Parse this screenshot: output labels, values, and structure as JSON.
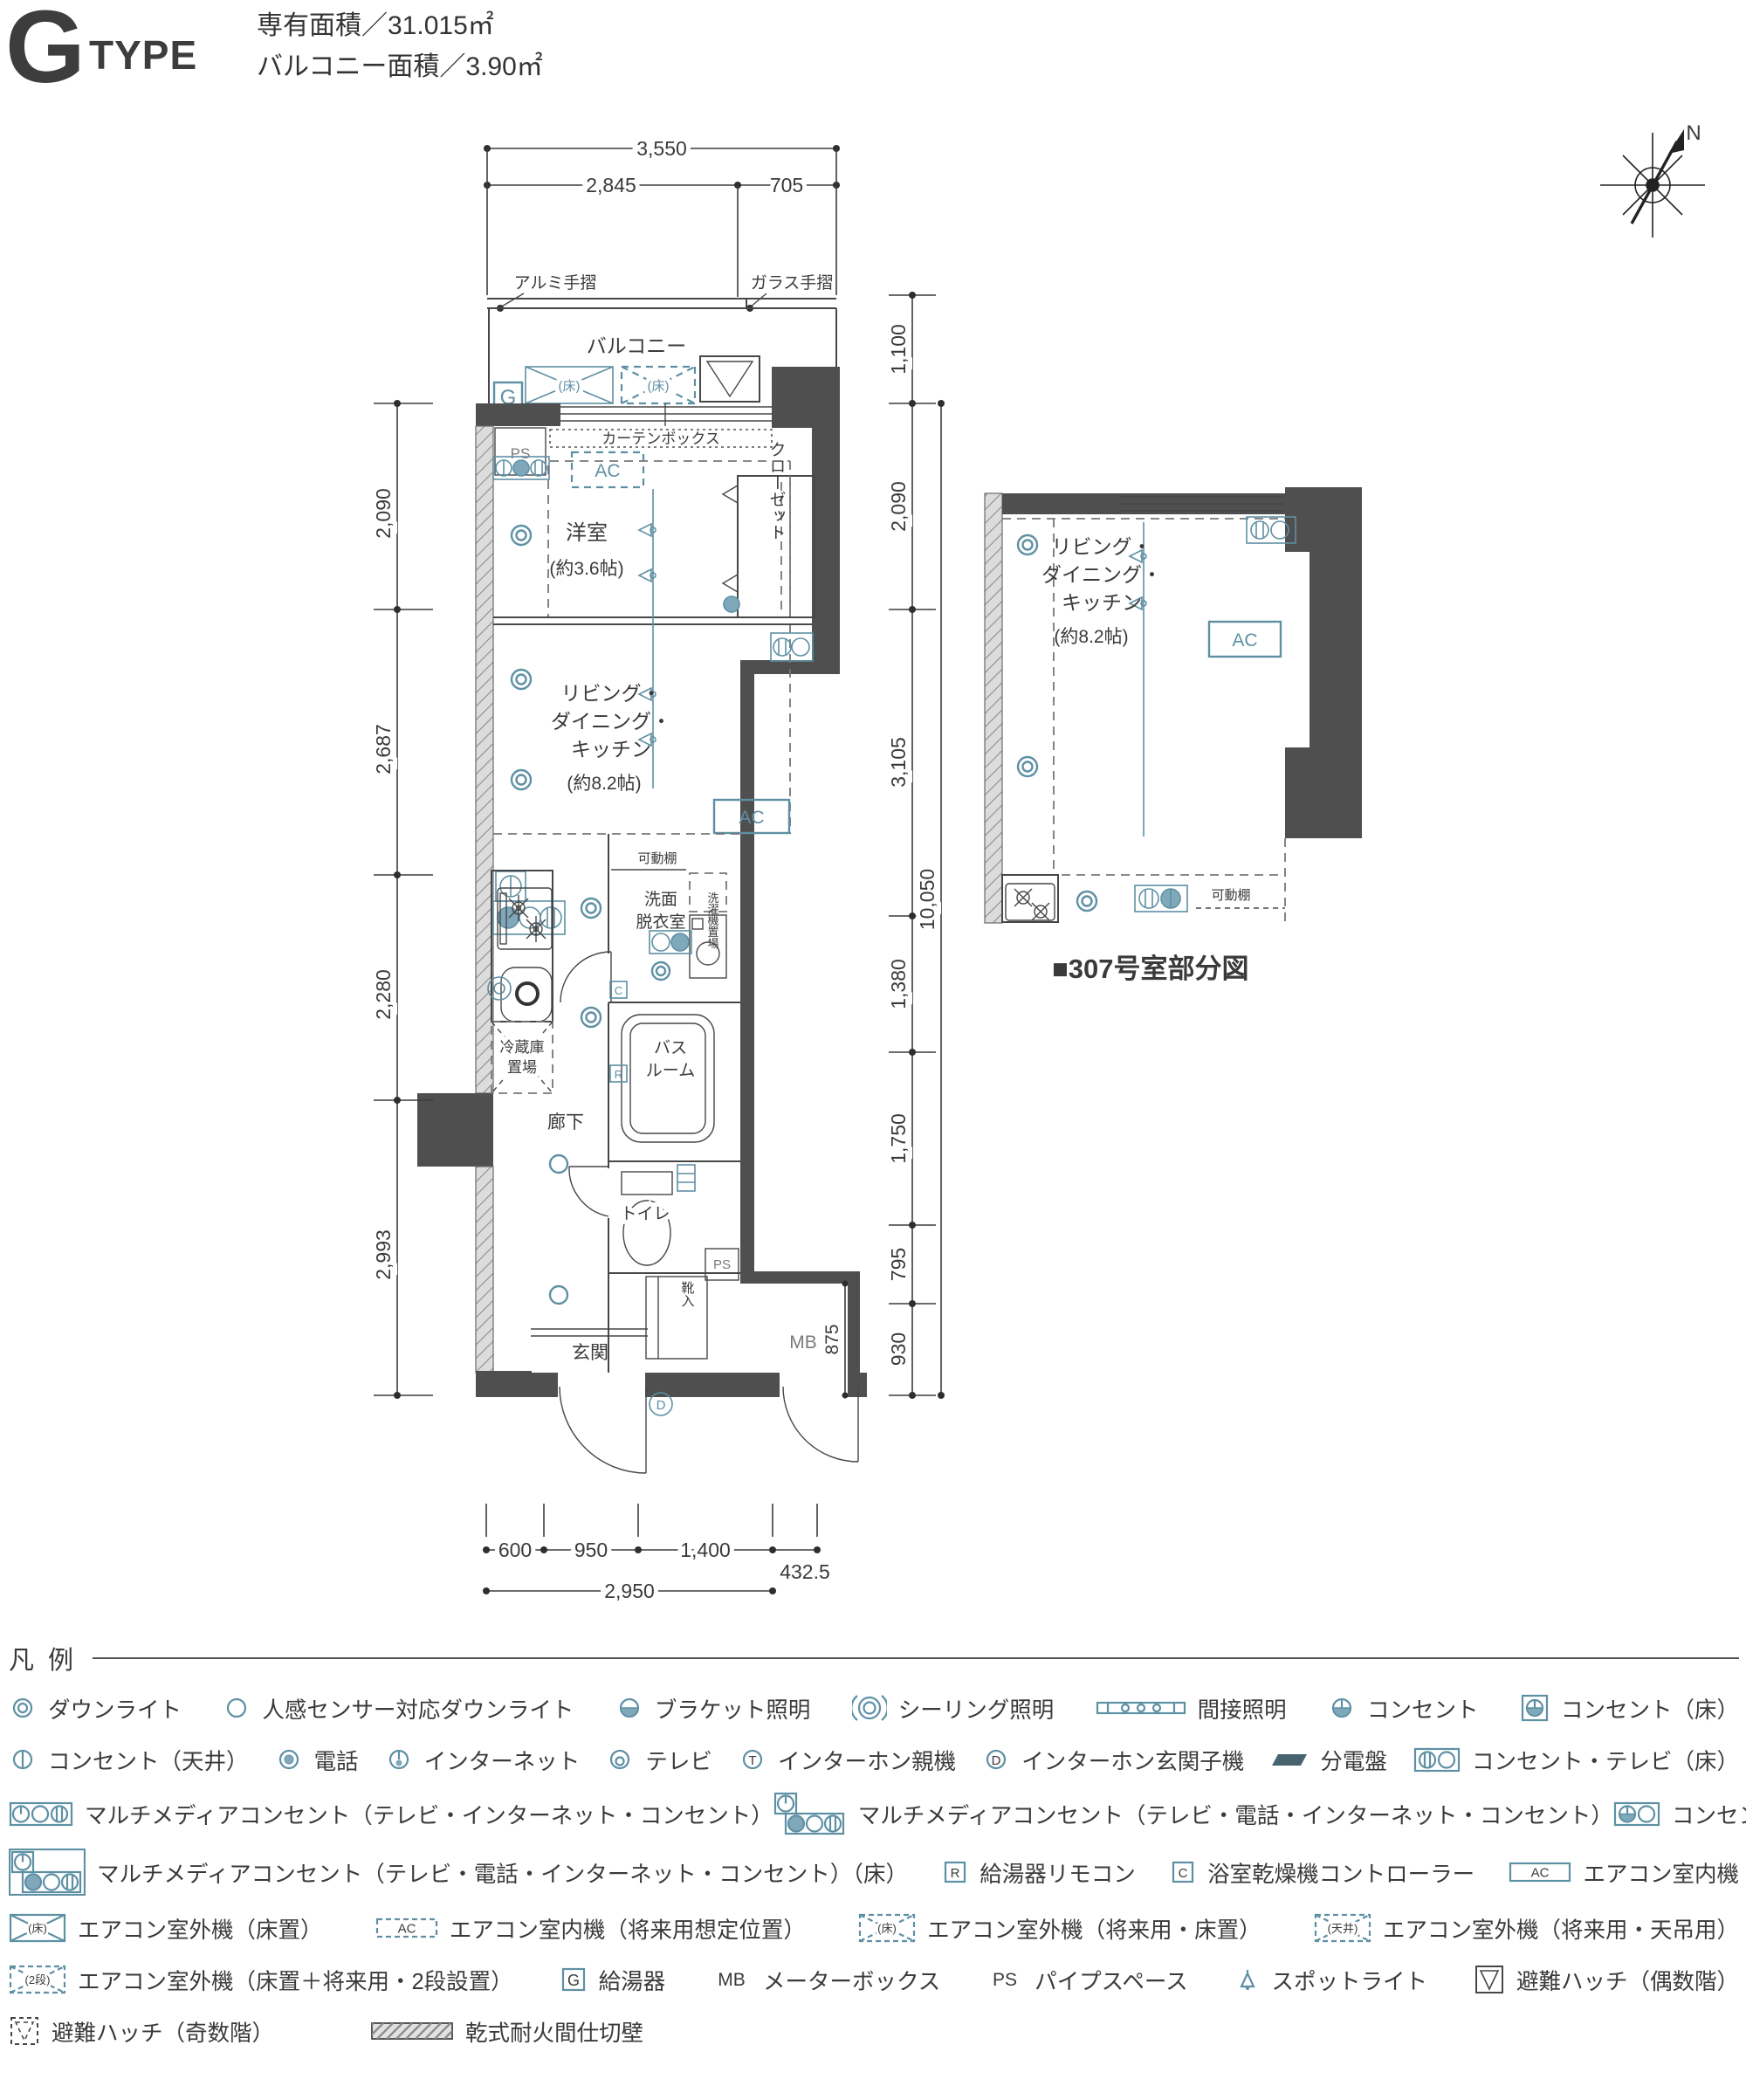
{
  "header": {
    "type_letter": "G",
    "type_word": "TYPE",
    "area_line1": "専有面積／31.015㎡",
    "area_line2": "バルコニー面積／3.90㎡"
  },
  "compass": {
    "n_label": "N"
  },
  "plan": {
    "labels": {
      "aluminum_rail": "アルミ手摺",
      "glass_rail": "ガラス手摺",
      "balcony": "バルコニー",
      "g": "G",
      "floor_mark": "(床)",
      "ps": "PS",
      "curtain_box": "カーテンボックス",
      "ac": "AC",
      "closet": "クローゼット",
      "yoshitsu": "洋室",
      "yoshitsu_size": "(約3.6帖)",
      "ldk1": "リビング・",
      "ldk2": "ダイニング・",
      "ldk3": "キッチン",
      "ldk_size": "(約8.2帖)",
      "kadou_tana": "可動棚",
      "senmen1": "洗面",
      "senmen2": "脱衣室",
      "sentakuki": "洗濯機置場",
      "tsurido": "吊戸棚",
      "reizouko1": "冷蔵庫",
      "reizouko2": "置場",
      "bath1": "バス",
      "bath2": "ルーム",
      "rouka": "廊下",
      "toilet": "トイレ",
      "genkan": "玄関",
      "kutsuire": "靴入",
      "mb": "MB",
      "r": "R",
      "c": "C",
      "d": "D"
    },
    "dims": {
      "top_total": "3,550",
      "top_left": "2,845",
      "top_right": "705",
      "right_balcony": "1,100",
      "right_1": "2,090",
      "right_2": "3,105",
      "right_3": "1,380",
      "right_4": "1,750",
      "right_5": "795",
      "right_6": "930",
      "right_total": "10,050",
      "right_inner": "875",
      "left_1": "2,090",
      "left_2": "2,687",
      "left_3": "2,280",
      "left_4": "2,993",
      "bottom_1": "600",
      "bottom_2": "950",
      "bottom_3": "1,400",
      "bottom_4": "432.5",
      "bottom_total": "2,950"
    }
  },
  "partial": {
    "caption": "■307号室部分図"
  },
  "legend": {
    "title": "凡 例",
    "icon_text": {
      "g": "G",
      "mb": "MB",
      "ps": "PS",
      "r": "R",
      "c": "C",
      "ac": "AC",
      "t": "T",
      "d": "D",
      "floor": "(床)",
      "ceiling": "(天井)",
      "two_dan": "(2段)"
    },
    "rows": [
      {
        "layout": "between",
        "items": [
          {
            "icon": "downlight",
            "label": "ダウンライト"
          },
          {
            "icon": "sensor-downlight",
            "label": "人感センサー対応ダウンライト"
          },
          {
            "icon": "bracket",
            "label": "ブラケット照明"
          },
          {
            "icon": "ceiling-light",
            "label": "シーリング照明"
          },
          {
            "icon": "indirect",
            "label": "間接照明"
          },
          {
            "icon": "outlet",
            "label": "コンセント"
          },
          {
            "icon": "outlet-floor",
            "label": "コンセント（床）"
          }
        ]
      },
      {
        "layout": "between",
        "items": [
          {
            "icon": "outlet-ceiling",
            "label": "コンセント（天井）"
          },
          {
            "icon": "phone",
            "label": "電話"
          },
          {
            "icon": "internet",
            "label": "インターネット"
          },
          {
            "icon": "tv",
            "label": "テレビ"
          },
          {
            "icon": "intercom-main",
            "label": "インターホン親機"
          },
          {
            "icon": "intercom-door",
            "label": "インターホン玄関子機"
          },
          {
            "icon": "panel",
            "label": "分電盤"
          },
          {
            "icon": "outlet-tv-floor",
            "label": "コンセント・テレビ（床）"
          }
        ]
      },
      {
        "layout": "between",
        "items": [
          {
            "icon": "mm3",
            "label": "マルチメディアコンセント（テレビ・インターネット・コンセント）"
          },
          {
            "icon": "mm4",
            "label": "マルチメディアコンセント（テレビ・電話・インターネット・コンセント）"
          },
          {
            "icon": "outlet-tv",
            "label": "コンセント・テレビ"
          }
        ]
      },
      {
        "layout": "between",
        "items": [
          {
            "icon": "mm4-floor",
            "label": "マルチメディアコンセント（テレビ・電話・インターネット・コンセント）（床）"
          },
          {
            "icon": "remote-r",
            "label": "給湯器リモコン"
          },
          {
            "icon": "remote-c",
            "label": "浴室乾燥機コントローラー"
          },
          {
            "icon": "ac-indoor",
            "label": "エアコン室内機"
          }
        ]
      },
      {
        "layout": "between",
        "items": [
          {
            "icon": "ac-outdoor",
            "label": "エアコン室外機（床置）"
          },
          {
            "icon": "ac-indoor-future",
            "label": "エアコン室内機（将来用想定位置）"
          },
          {
            "icon": "ac-outdoor-future-floor",
            "label": "エアコン室外機（将来用・床置）"
          },
          {
            "icon": "ac-outdoor-future-ceiling",
            "label": "エアコン室外機（将来用・天吊用）"
          }
        ]
      },
      {
        "layout": "between",
        "items": [
          {
            "icon": "ac-outdoor-2dan",
            "label": "エアコン室外機（床置＋将来用・2段設置）"
          },
          {
            "icon": "boiler",
            "label": "給湯器"
          },
          {
            "icon": "mb",
            "label": "メーターボックス"
          },
          {
            "icon": "ps",
            "label": "パイプスペース"
          },
          {
            "icon": "spotlight",
            "label": "スポットライト"
          },
          {
            "icon": "hatch-even",
            "label": "避難ハッチ（偶数階）"
          }
        ]
      },
      {
        "layout": "start",
        "items": [
          {
            "icon": "hatch-odd",
            "label": "避難ハッチ（奇数階）"
          },
          {
            "icon": "firewall",
            "label": "乾式耐火間仕切壁"
          }
        ]
      }
    ]
  }
}
